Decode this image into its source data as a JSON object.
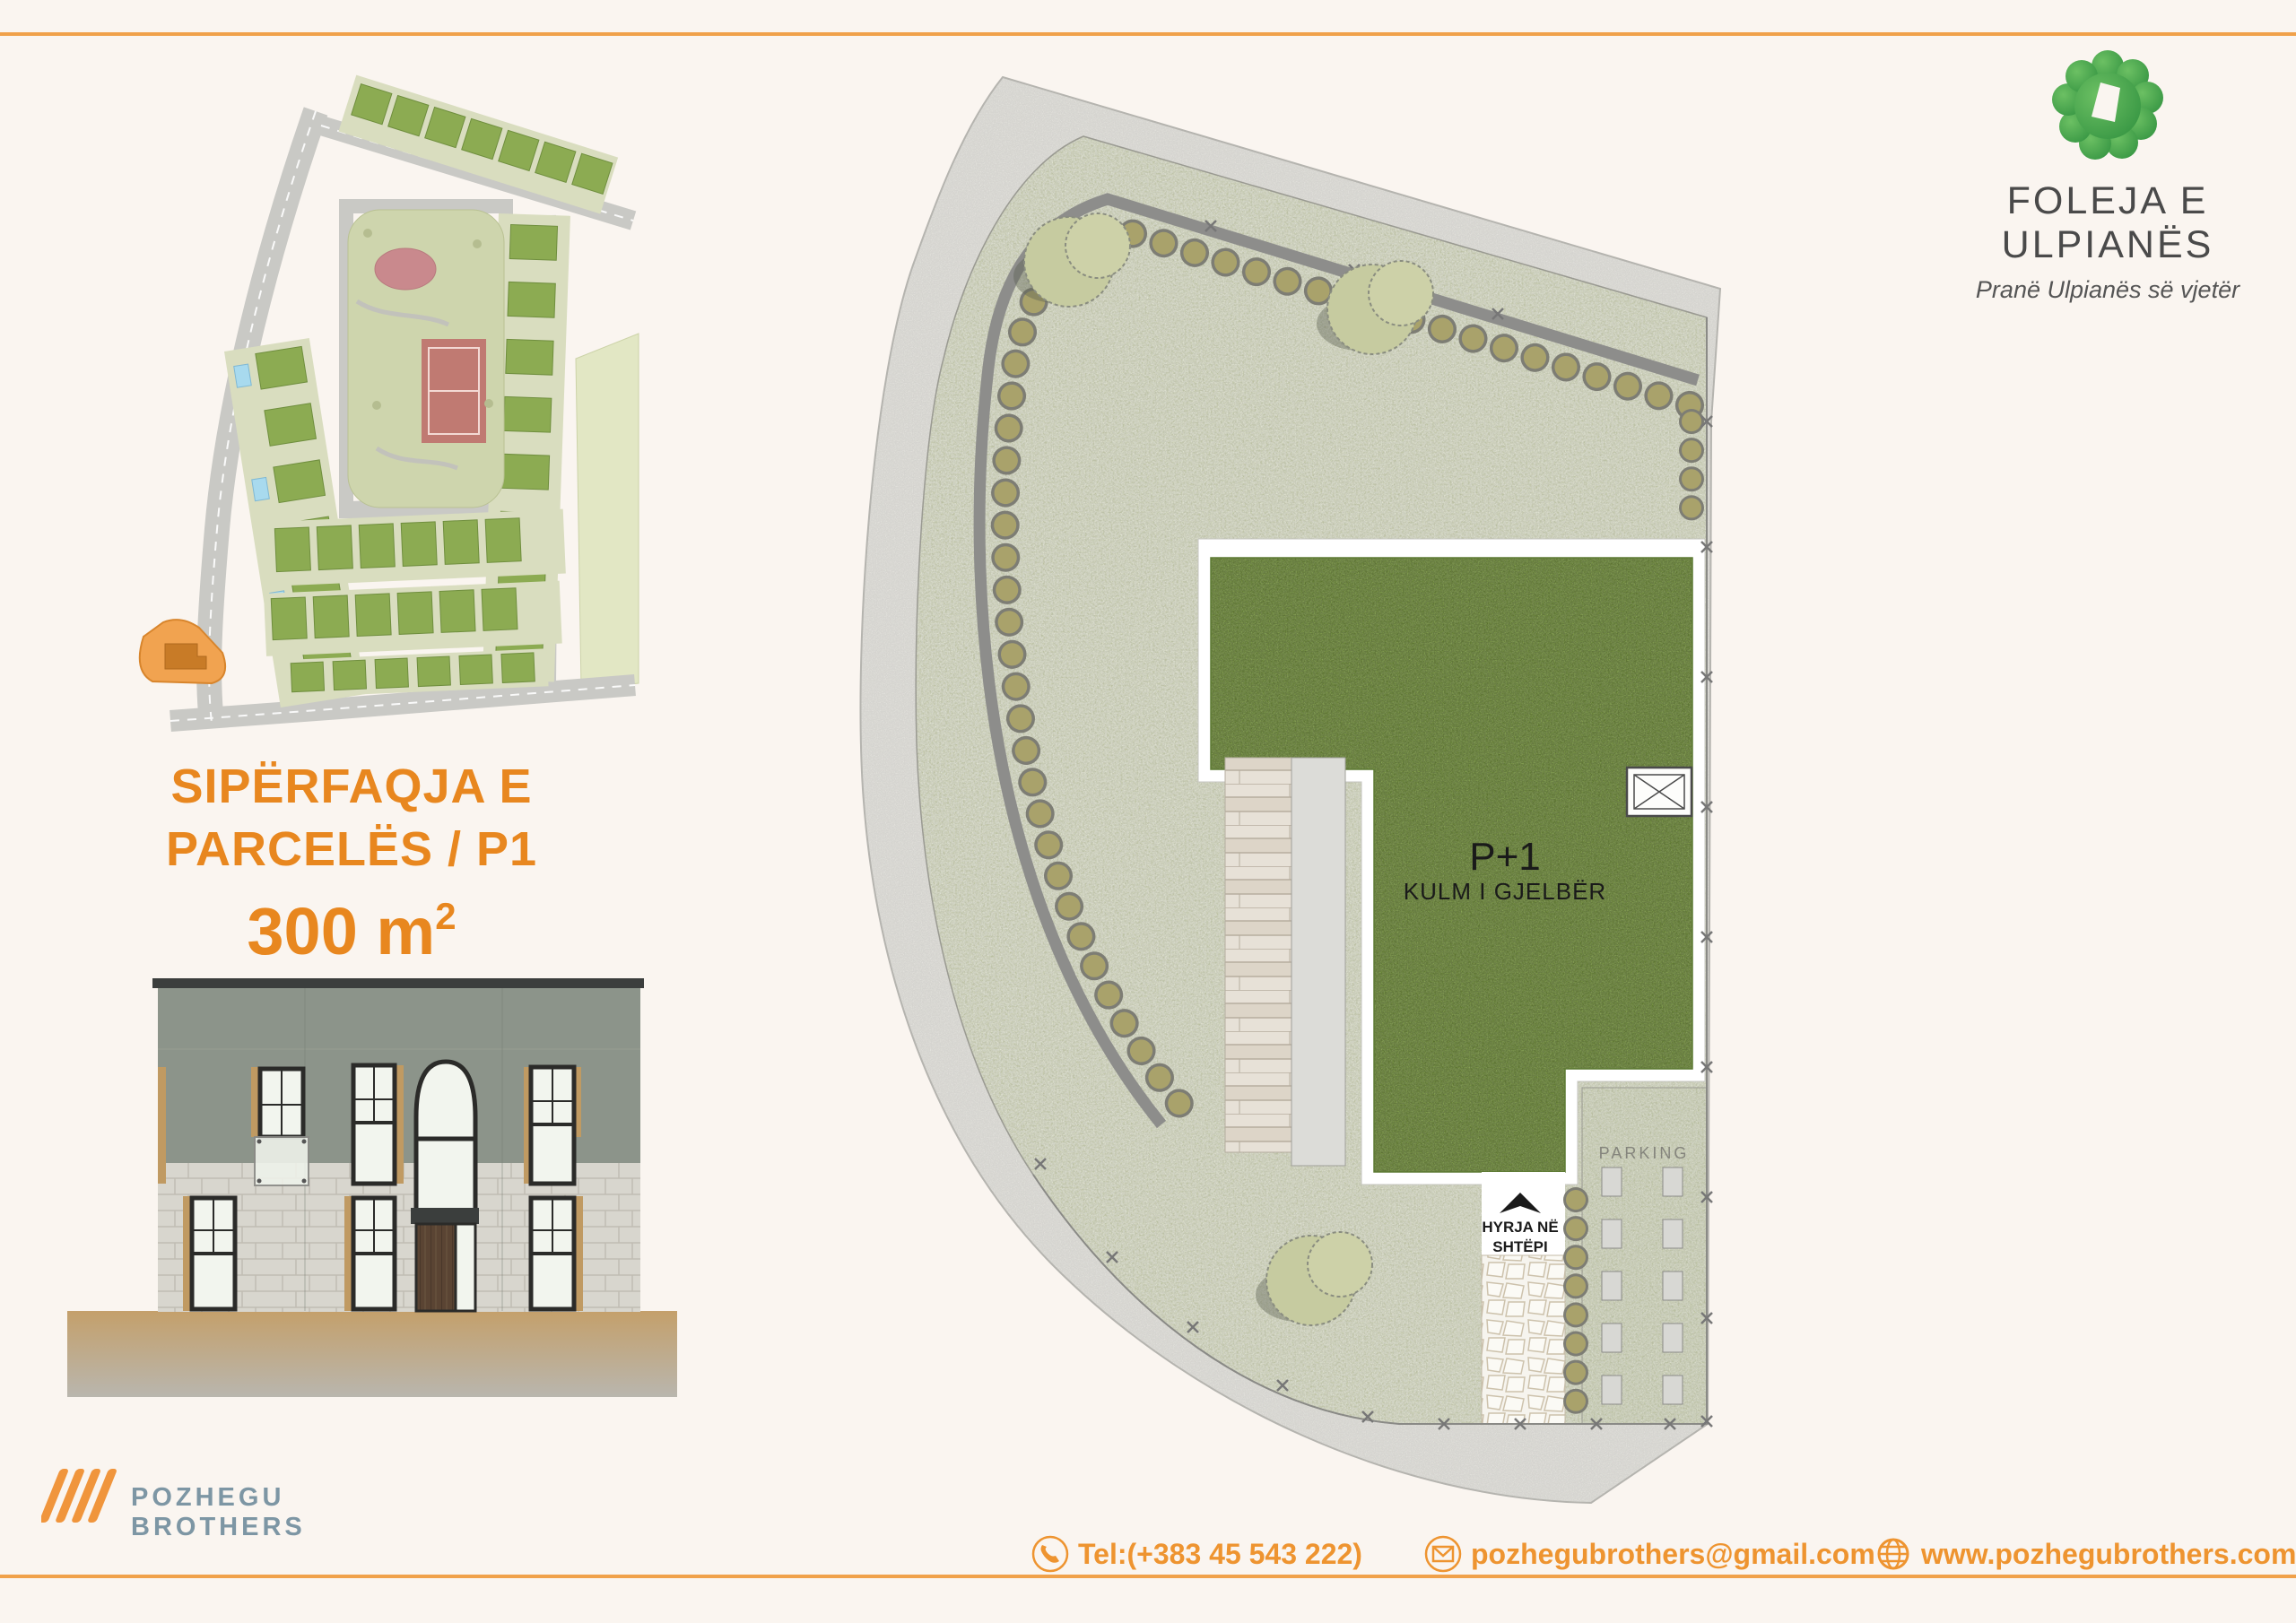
{
  "brand": {
    "title": "FOLEJA E ULPIANËS",
    "subtitle": "Pranë Ulpianës së vjetër"
  },
  "area_label": {
    "line1": "SIPËRFAQJA E",
    "line2": "PARCELËS / P1",
    "value": "300 m",
    "value_sup": "2"
  },
  "siteplan": {
    "building_label": "P+1",
    "building_sublabel": "KULM I GJELBËR",
    "parking_label": "PARKING",
    "entrance_line1": "HYRJA NË",
    "entrance_line2": "SHTËPI"
  },
  "company": {
    "name_line1": "POZHEGU",
    "name_line2": "BROTHERS"
  },
  "contact": {
    "phone": "Tel:(+383 45 543 222)",
    "email": "pozhegubrothers@gmail.com",
    "website": "www.pozhegubrothers.com"
  },
  "colors": {
    "accent_orange": "#EE9430",
    "headline_orange": "#E8871F",
    "logo_green": "#41A046",
    "company_slate": "#7D96A4",
    "roof_green": "#7C9B43",
    "garden_sage": "#CDD2B2",
    "parcel_highlight": "#F1A350"
  }
}
